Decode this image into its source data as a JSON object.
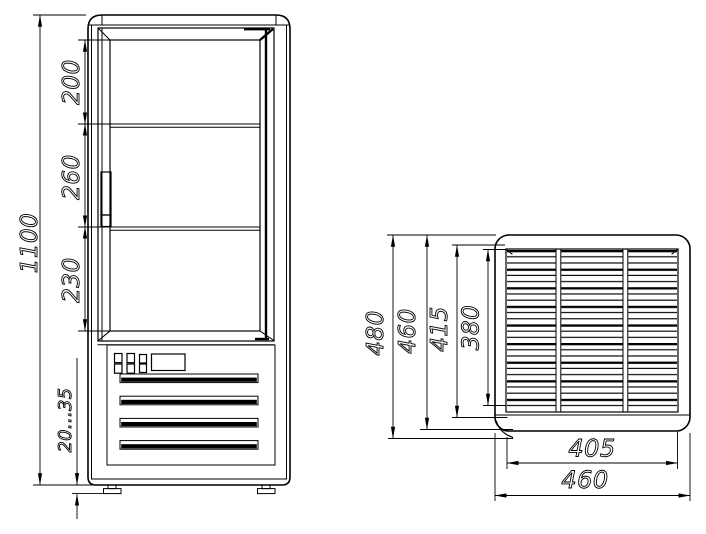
{
  "views": {
    "front": {
      "dimensions": {
        "overall_height": "1100",
        "upper_shelf_spacing": "200",
        "middle_shelf_spacing": "260",
        "lower_shelf_spacing": "230",
        "leg_height_range": "20...35"
      }
    },
    "top": {
      "dimensions": {
        "overall_depth": "480",
        "body_depth": "460",
        "grille_outer_depth": "415",
        "grille_depth": "380",
        "grille_width": "405",
        "body_width": "460"
      }
    }
  },
  "colors": {
    "line": "#000000",
    "background": "#ffffff"
  }
}
